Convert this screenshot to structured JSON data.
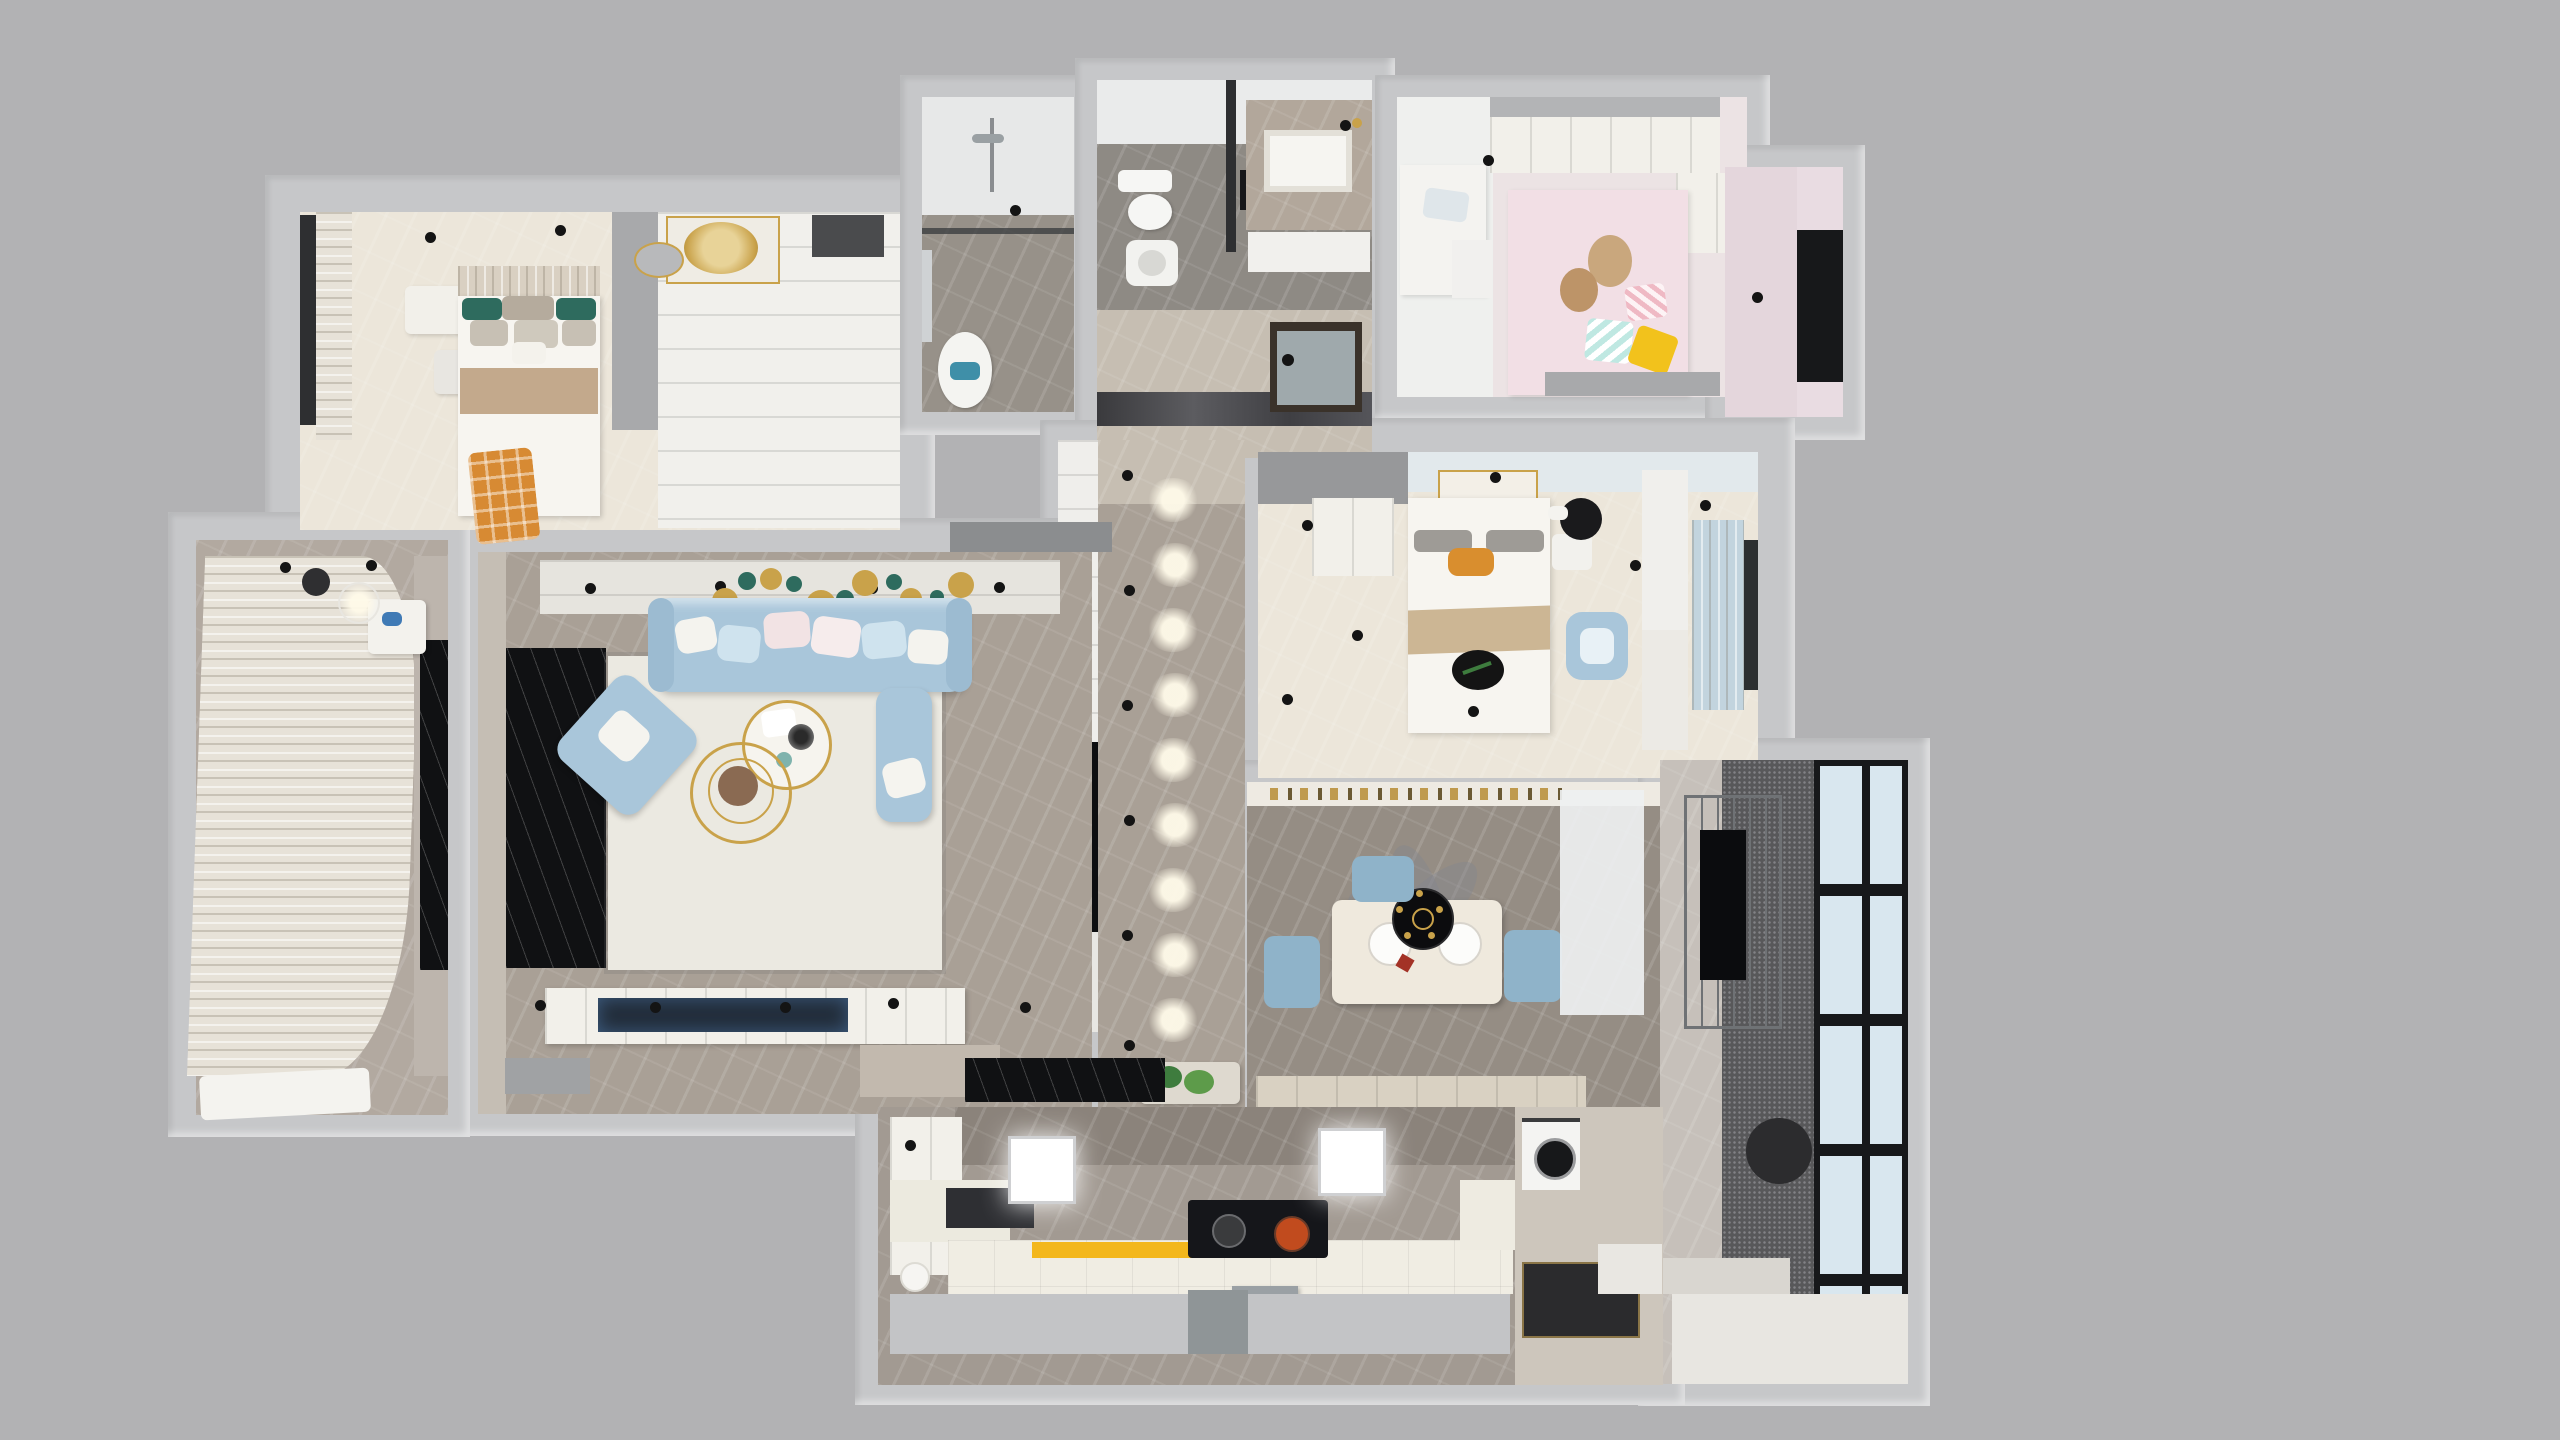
{
  "image": {
    "type": "3d-apartment-floor-plan-top-down-render",
    "text_visible": false
  },
  "palette": {
    "background": "#b2b2b4",
    "wall": "#c6c7c9",
    "floor_cream": "#ece6da",
    "floor_white": "#f1f0ec",
    "floor_marble_gray": "#a9a096",
    "floor_marble_dark": "#958d84",
    "floor_beige": "#c6beb2",
    "floor_pink": "#ece3e4",
    "floor_bath": "#979189",
    "floor_toilet": "#8e8a84",
    "floor_kitchen": "#a29a92",
    "backsplash_dark": "#8b837b",
    "floor_entry": "#cdc6bc",
    "marble_black": "#101113",
    "balcony_marble": "#b2a9a0",
    "balcony_right_speckle": "#58585a",
    "balcony_right_marble": "#c6c0ba",
    "window_glass": "#d9e7ef",
    "frame_black": "#17181a",
    "curtain_cream": "#e7e2d8",
    "curtain_blue": "#c2d4de",
    "curtain_pink": "#e9dce2",
    "sofa_blue": "#a9c6da",
    "chair_blue": "#8fb3c9",
    "rug_white": "#ebe9e1",
    "bed_white": "#f7f5f0",
    "headboard_beige": "#d9d0c2",
    "blanket_tan": "#c3a98c",
    "blanket_tan_master": "#ccb694",
    "accent_orange": "#d78a33",
    "pillow_orange": "#d98e2e",
    "accent_yellow": "#f3b71c",
    "pillow_yellow": "#f2c21c",
    "accent_teal": "#2e6b5e",
    "towel_teal": "#3f8fa8",
    "gold": "#c9a24a",
    "counter_white": "#f0ede3",
    "cabinet_white": "#f2f0ea",
    "console_white": "#f2f0ea",
    "appliance_dark": "#15161a",
    "pan_red": "#c14b1e",
    "mat_dark": "#2b2b2d",
    "plant_green": "#3e7c3e",
    "ceiling_strip": "#e6e4de",
    "ceiling_blue_tint": "#e2e9ec",
    "gray_panel": "#a8a9ab",
    "tv_screen": "#222d3a",
    "shelf_white": "#efeeeb",
    "sideboard_beige": "#d9d1c2",
    "vanity_marble": "#b2a79b",
    "light_panel": "#ffffff"
  },
  "rooms": [
    {
      "name": "secondary-bedroom",
      "furniture": [
        "double-bed",
        "headboard-pillows",
        "tan-blanket",
        "orange-plaid-throw",
        "dresser",
        "stool",
        "gold-chandelier",
        "oval-mirror",
        "window-curtain",
        "closet-area",
        "gray-divider-panel"
      ]
    },
    {
      "name": "shower-bathroom",
      "furniture": [
        "shower-set",
        "glass-partition",
        "washbasin",
        "teal-towel"
      ]
    },
    {
      "name": "toilet-bathroom",
      "furniture": [
        "toilet",
        "squat-pan",
        "partition",
        "storage-cabinet",
        "marble-vanity",
        "basin"
      ]
    },
    {
      "name": "hallway",
      "furniture": [
        "dark-glass-door",
        "gloss-floor-band"
      ]
    },
    {
      "name": "kids-room",
      "furniture": [
        "study-desk",
        "laptop",
        "drawer-unit",
        "wardrobe-cabinets",
        "pink-bed",
        "teddy-bears",
        "striped-pillows",
        "yellow-pillow",
        "window-curtain",
        "dark-window"
      ]
    },
    {
      "name": "corridor",
      "furniture": [
        "white-shelving",
        "black-tv-panel",
        "recessed-light-glows",
        "downlight-dots",
        "planter-box"
      ]
    },
    {
      "name": "master-bedroom",
      "furniture": [
        "double-bed",
        "tufted-headboard",
        "gray-pillows",
        "orange-pillow",
        "tan-blanket",
        "black-tray",
        "wardrobe",
        "gray-cabinet",
        "artwork",
        "nightstand",
        "black-round-table",
        "blue-armchair",
        "shelving-column",
        "blue-striped-curtain"
      ]
    },
    {
      "name": "living-room",
      "furniture": [
        "blue-leather-sofa",
        "throw-pillows",
        "blue-armchair",
        "blue-chaise",
        "round-coffee-table",
        "gold-ring-table",
        "area-rug",
        "black-marble-band",
        "ceiling-strip-decor",
        "tv-console",
        "flat-tv",
        "gray-side-box"
      ]
    },
    {
      "name": "left-balcony",
      "furniture": [
        "long-cream-curtain",
        "marble-band",
        "black-marble-band",
        "side-table",
        "pendant-lamp",
        "bench"
      ]
    },
    {
      "name": "dining-room",
      "furniture": [
        "marble-dining-table",
        "place-settings",
        "blue-dining-chairs",
        "ceiling-fan-light",
        "decor-shelf",
        "sheer-curtain",
        "sideboard"
      ]
    },
    {
      "name": "right-balcony",
      "furniture": [
        "drying-rack",
        "black-panel",
        "grid-glass-window",
        "dark-round-rug",
        "white-floor-step"
      ]
    },
    {
      "name": "kitchen",
      "furniture": [
        "upper-cabinet",
        "l-shaped-counter",
        "yellow-mat",
        "induction-cooktop",
        "red-pan",
        "hood-box",
        "black-sink",
        "light-panels",
        "washing-machine",
        "dark-door-mat"
      ]
    }
  ]
}
